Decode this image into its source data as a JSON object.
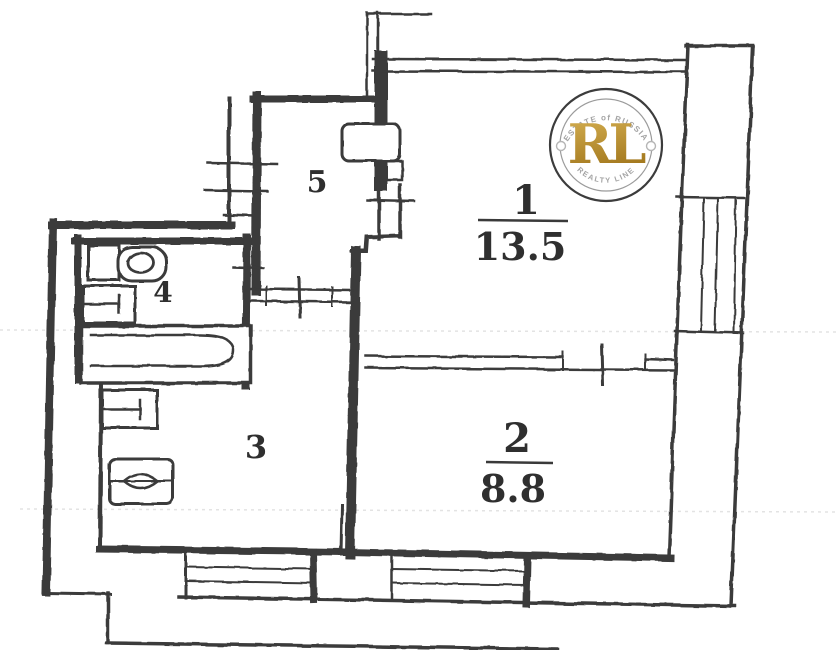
{
  "colors": {
    "ink": "#3a3a3a",
    "paper": "#ffffff",
    "streak": "#e3e3e3"
  },
  "rooms": [
    {
      "number": "1",
      "area": "13.5"
    },
    {
      "number": "2",
      "area": "8.8"
    },
    {
      "number": "3",
      "area": ""
    },
    {
      "number": "4",
      "area": ""
    },
    {
      "number": "5",
      "area": ""
    }
  ],
  "logo": {
    "initials": "RL",
    "arc_top": "ESTATE of RUSSIA",
    "arc_bottom": "REALTY LINE",
    "ring_color": "#3c3c3c",
    "inner_ring_color": "#9b9b9b",
    "text_color": "#a3a3a3",
    "gold_light": "#d7b254",
    "gold_dark": "#a1761c"
  }
}
